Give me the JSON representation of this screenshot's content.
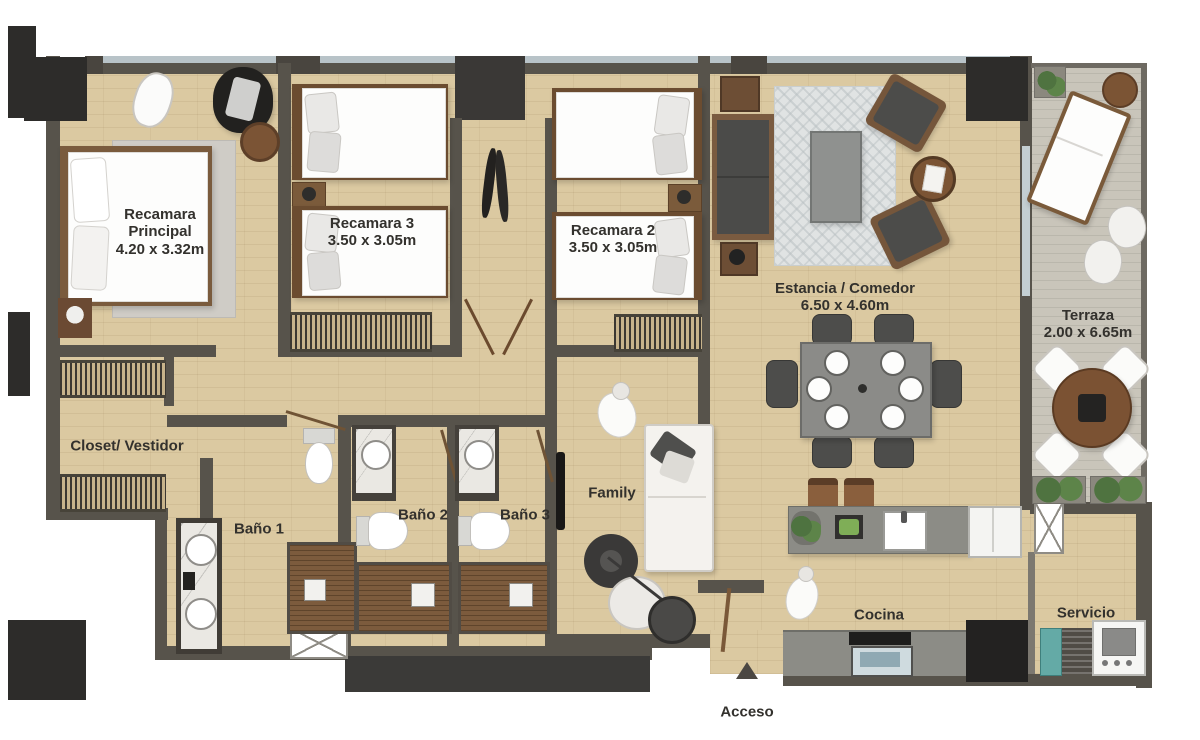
{
  "plan_title": "Apartment floor plan",
  "rooms": {
    "recamara_principal": {
      "name": "Recamara\nPrincipal",
      "dims": "4.20 x 3.32m"
    },
    "recamara3": {
      "name": "Recamara 3",
      "dims": "3.50 x 3.05m"
    },
    "recamara2": {
      "name": "Recamara 2",
      "dims": "3.50 x 3.05m"
    },
    "estancia": {
      "name": "Estancia / Comedor",
      "dims": "6.50 x 4.60m"
    },
    "terraza": {
      "name": "Terraza",
      "dims": "2.00 x 6.65m"
    },
    "closet": {
      "name": "Closet/ Vestidor"
    },
    "bano1": {
      "name": "Baño 1"
    },
    "bano2": {
      "name": "Baño 2"
    },
    "bano3": {
      "name": "Baño 3"
    },
    "family": {
      "name": "Family"
    },
    "cocina": {
      "name": "Cocina"
    },
    "servicio": {
      "name": "Servicio"
    },
    "acceso": {
      "name": "Acceso"
    }
  },
  "palette": {
    "floor_wood": "#dbc9a1",
    "floor_terrace": "#c9c5ba",
    "wall": "#57534b",
    "wood_accent": "#7a5b3d",
    "dark_block": "#2d2c2a",
    "window_glass": "#b8c3c8"
  }
}
